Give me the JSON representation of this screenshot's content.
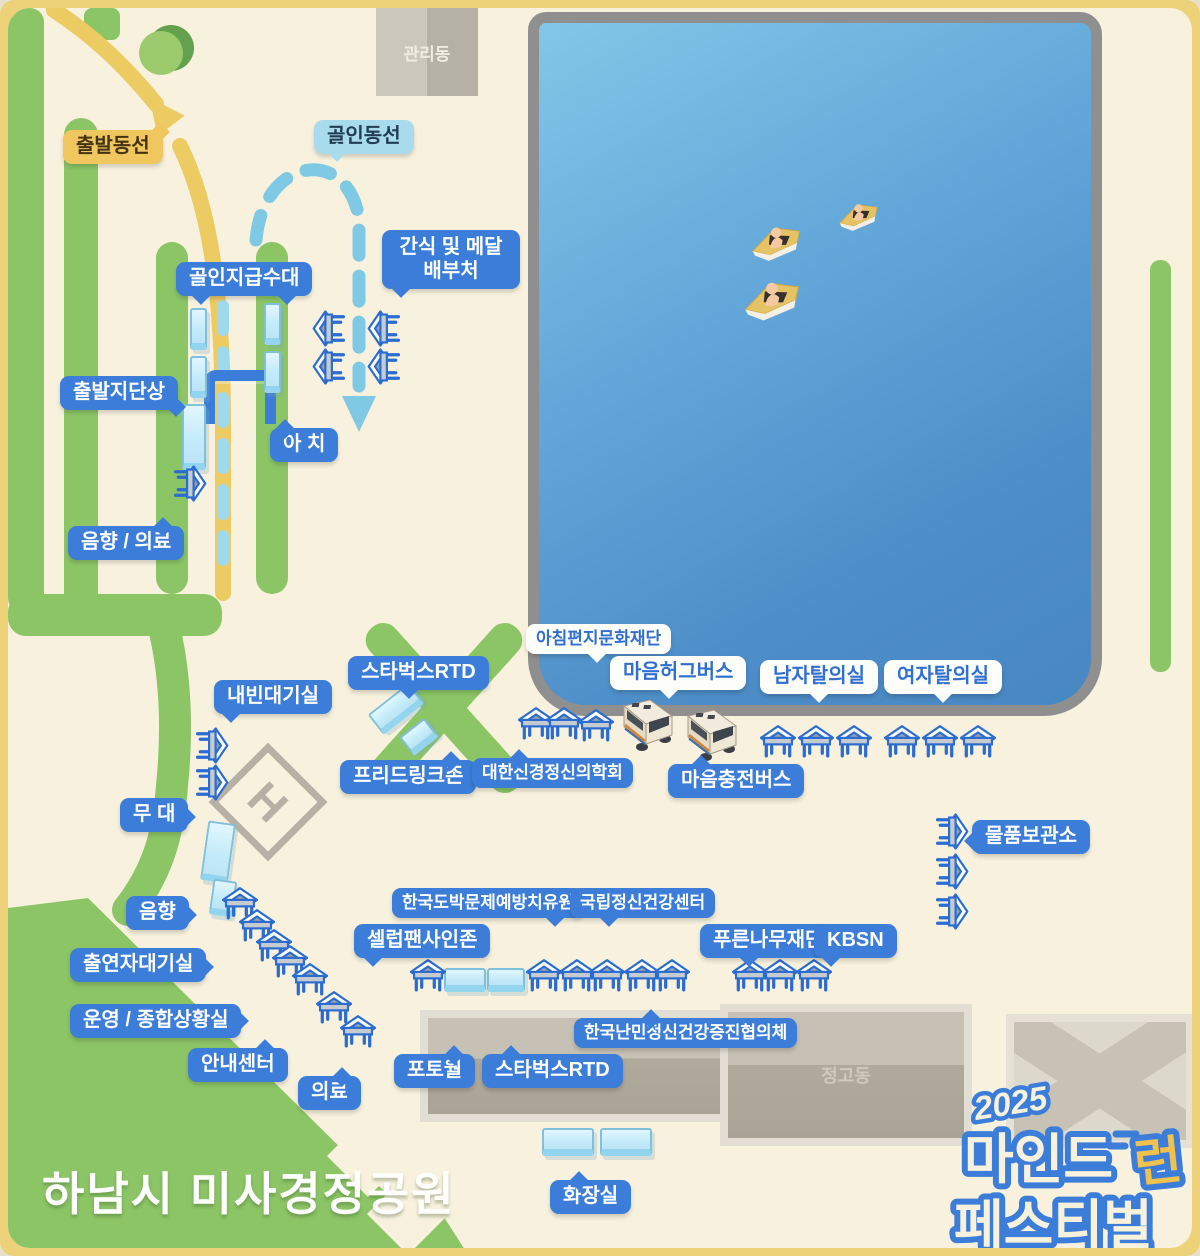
{
  "park_name": "하남시 미사경정공원",
  "logo": {
    "year": "2025",
    "word1": "마인드",
    "word2": "런",
    "word3": "페스티벌"
  },
  "buildings": {
    "admin": "관리동",
    "depot": "정고동"
  },
  "routes": {
    "start": "출발동선",
    "finish": "골인동선"
  },
  "helipad": "H",
  "labels": {
    "snack": "간식 및 메달 배부처",
    "finish_water": "골인지급수대",
    "start_stage": "출발지단상",
    "arch": "아 치",
    "sound_medical": "음향 / 의료",
    "vip": "내빈대기실",
    "starbucks_top": "스타벅스RTD",
    "free_drink": "프리드링크존",
    "morning_letter": "아침편지문화재단",
    "hug_bus": "마음허그버스",
    "neuro": "대한신경정신의학회",
    "charge_bus": "마음충전버스",
    "men_changing": "남자탈의실",
    "women_changing": "여자탈의실",
    "storage": "물품보관소",
    "stage": "무 대",
    "sound": "음향",
    "performer": "출연자대기실",
    "operation": "운영 / 종합상황실",
    "info": "안내센터",
    "medical": "의료",
    "celeb": "셀럽팬사인존",
    "gambling": "한국도박문제예방치유원",
    "mental_center": "국립정신건강센터",
    "refugee": "한국난민정신건강증진협의체",
    "photo_wall": "포토월",
    "starbucks_bottom": "스타벅스RTD",
    "green_tree": "푸른나무재단",
    "kbsn": "KBSN",
    "toilet": "화장실"
  },
  "colors": {
    "frame": "#eed27a",
    "ground": "#f8f1de",
    "green": "#8cc566",
    "water": "#5b9fd6",
    "label_blue": "#3b7dd8",
    "start_path": "#eccb63",
    "finish_path": "#7fc9e4"
  }
}
